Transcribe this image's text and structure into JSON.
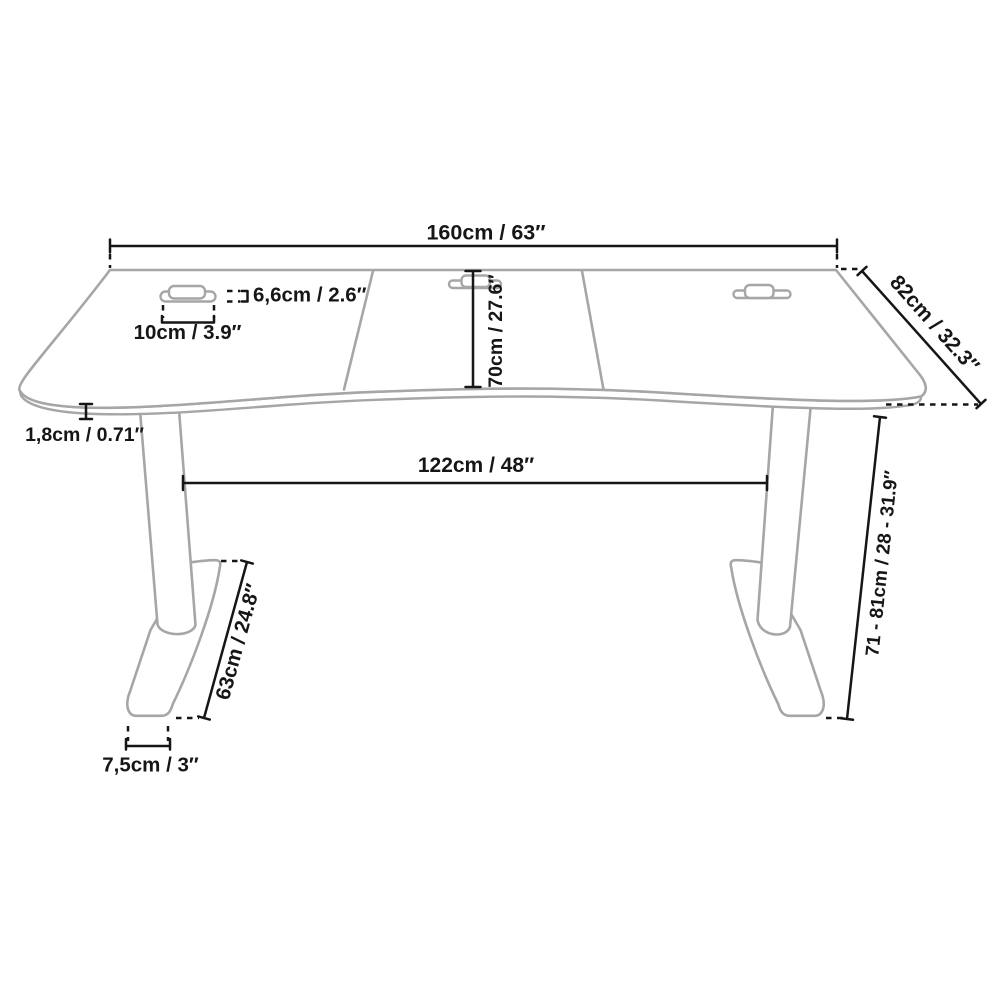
{
  "diagram": {
    "subject": "height-adjustable desk dimension drawing",
    "colors": {
      "outline_gray": "#a6a6a6",
      "dimension_black": "#161616",
      "background": "#ffffff"
    },
    "labels": {
      "width": "160cm / 63″",
      "depth": "82cm / 32.3″",
      "grommet_cover": "6,6cm / 2.6″",
      "grommet_width": "10cm / 3.9″",
      "surface_depth": "70cm / 27.6″",
      "top_thickness": "1,8cm / 0.71″",
      "leg_span": "122cm / 48″",
      "height_range": "71 - 81cm / 28 - 31.9″",
      "foot_length": "63cm / 24.8″",
      "foot_width": "7,5cm / 3″"
    }
  }
}
